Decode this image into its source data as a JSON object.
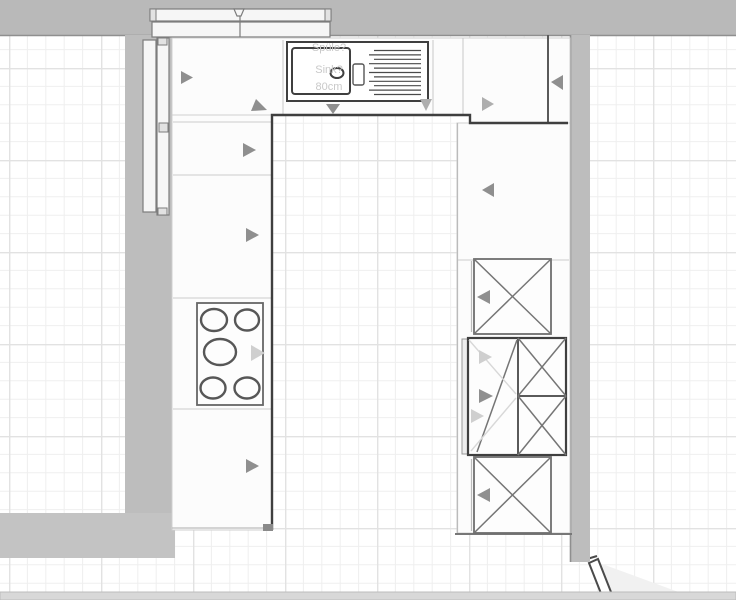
{
  "canvas": {
    "width": 736,
    "height": 600
  },
  "labels": {
    "sink_line1": "Spüle?",
    "sink_line2": "Sink?",
    "sink_line3": "80cm"
  },
  "fixtures": {
    "sink": {
      "name": "sink-with-drainer",
      "bowls": 1,
      "drainer_lines": 11
    },
    "hob": {
      "name": "hob",
      "burner_count": 5
    },
    "wall_cabinets_x_marked": 2,
    "tall_appliance_cabinet": 1,
    "tall_panels_left_wall": 2,
    "wall_cabinet_rail_top": 2,
    "door": {
      "name": "door",
      "position": "bottom-right",
      "state": "open"
    }
  },
  "colors": {
    "wall": "#bdbdbd",
    "wall_top": "#b9b9b9",
    "wall_band": "#c3c3c3",
    "bottom_strip": "#d8d8d8",
    "grid_minor": "#efefef",
    "grid_major": "#e2e2e2",
    "outline_dark": "#3f3f3f",
    "arrow_dark": "#8f8f8f",
    "arrow_light": "#cfcfcf",
    "label_text": "#c9c9c9",
    "door_swing": "#f1f1f1"
  }
}
